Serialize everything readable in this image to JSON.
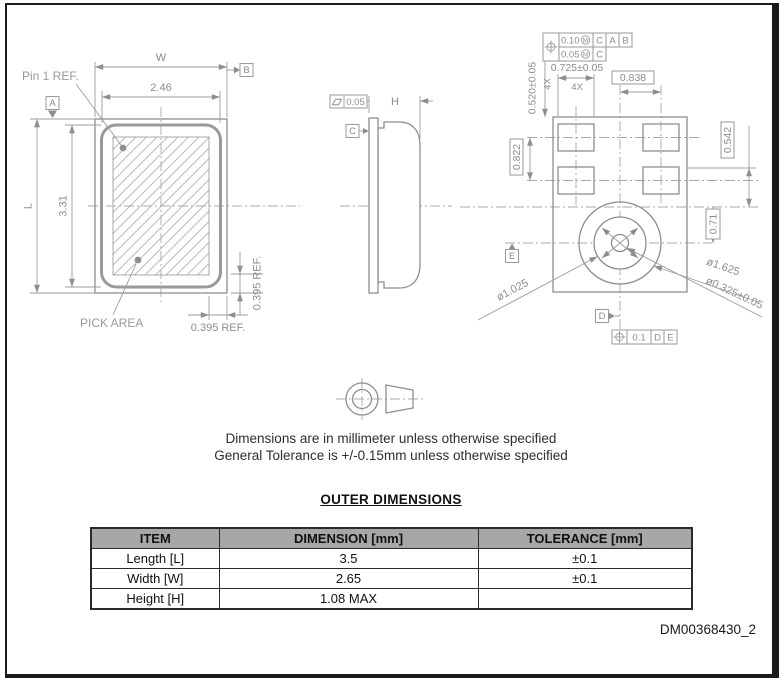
{
  "notes": {
    "line1": "Dimensions are in millimeter unless otherwise specified",
    "line2": "General Tolerance is +/-0.15mm unless otherwise specified"
  },
  "footer": {
    "doc_number": "DM00368430_2"
  },
  "front_view": {
    "w_label": "W",
    "w_dim": "2.46",
    "l_label": "L",
    "l_dim": "3.31",
    "pin1": "Pin 1 REF.",
    "pick_area": "PICK AREA",
    "ref_bottom": "0.395 REF.",
    "ref_right": "0.395 REF.",
    "datum_a": "A",
    "datum_b": "B"
  },
  "side_view": {
    "h_label": "H",
    "flatness": "0.05",
    "datum_c": "C"
  },
  "bottom_view": {
    "fcf": {
      "r1_tol": "0.10",
      "r1_mod": "M",
      "r1_d1": "C",
      "r1_d2": "A",
      "r1_d3": "B",
      "r2_tol": "0.05",
      "r2_mod": "M",
      "r2_d1": "C"
    },
    "dim_pad_w": "0.725±0.05",
    "qty_x": "4X",
    "dim_pad_h": "0.520±0.05",
    "qty_y": "4X",
    "dim_0838": "0.838",
    "dim_0822": "0.822",
    "dim_0542": "0.542",
    "dim_071": "0.71",
    "dia_inner": "ø1.025",
    "dia_outer": "ø1.625",
    "dia_hole": "ø0.325±0.05",
    "datum_d": "D",
    "datum_e": "E",
    "fcf2": {
      "tol": "0.1",
      "d1": "D",
      "d2": "E"
    }
  },
  "table": {
    "title": "OUTER DIMENSIONS",
    "headers": [
      "ITEM",
      "DIMENSION [mm]",
      "TOLERANCE [mm]"
    ],
    "rows": [
      [
        "Length [L]",
        "3.5",
        "±0.1"
      ],
      [
        "Width [W]",
        "2.65",
        "±0.1"
      ],
      [
        "Height [H]",
        "1.08 MAX",
        ""
      ]
    ]
  }
}
